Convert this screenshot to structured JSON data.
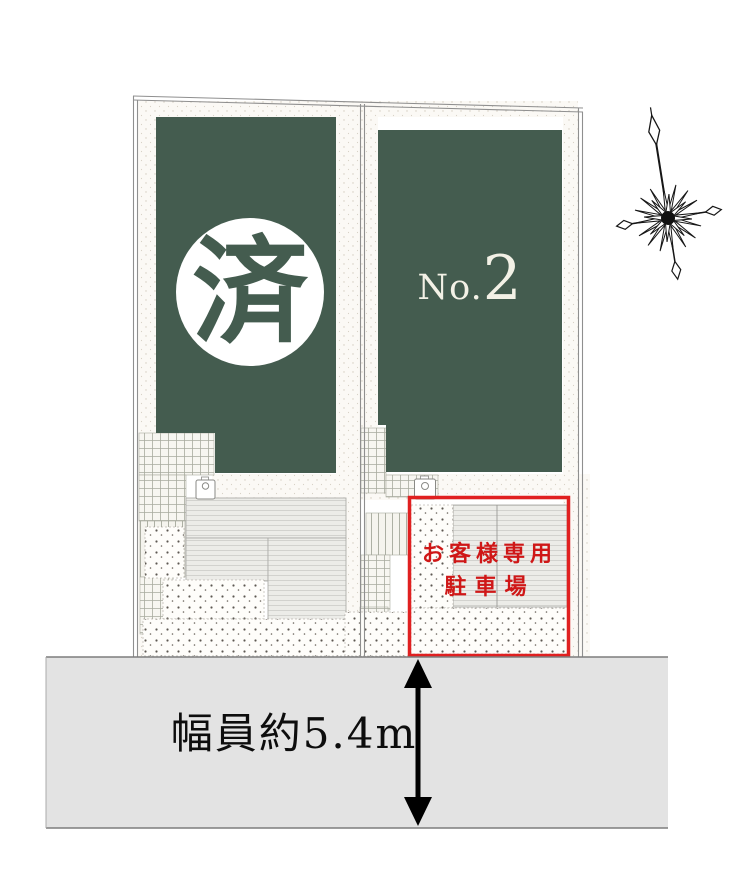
{
  "site_plan": {
    "lot_sold": {
      "badge": "済"
    },
    "lot_no2": {
      "prefix": "No.",
      "number": "2"
    },
    "customer_parking": {
      "line1": "お客様専用",
      "line2": "駐車場"
    },
    "road": {
      "width_label": "幅員約5.4m"
    }
  },
  "icons": {
    "compass": "compass-north-icon",
    "road_arrow": "road-width-arrow-icon",
    "water_meter": "water-meter-icon"
  },
  "colors": {
    "lot_green": "#445c4f",
    "parking_red": "#e02020",
    "parking_text_red": "#cf1717",
    "road_gray": "#e3e3e3"
  }
}
